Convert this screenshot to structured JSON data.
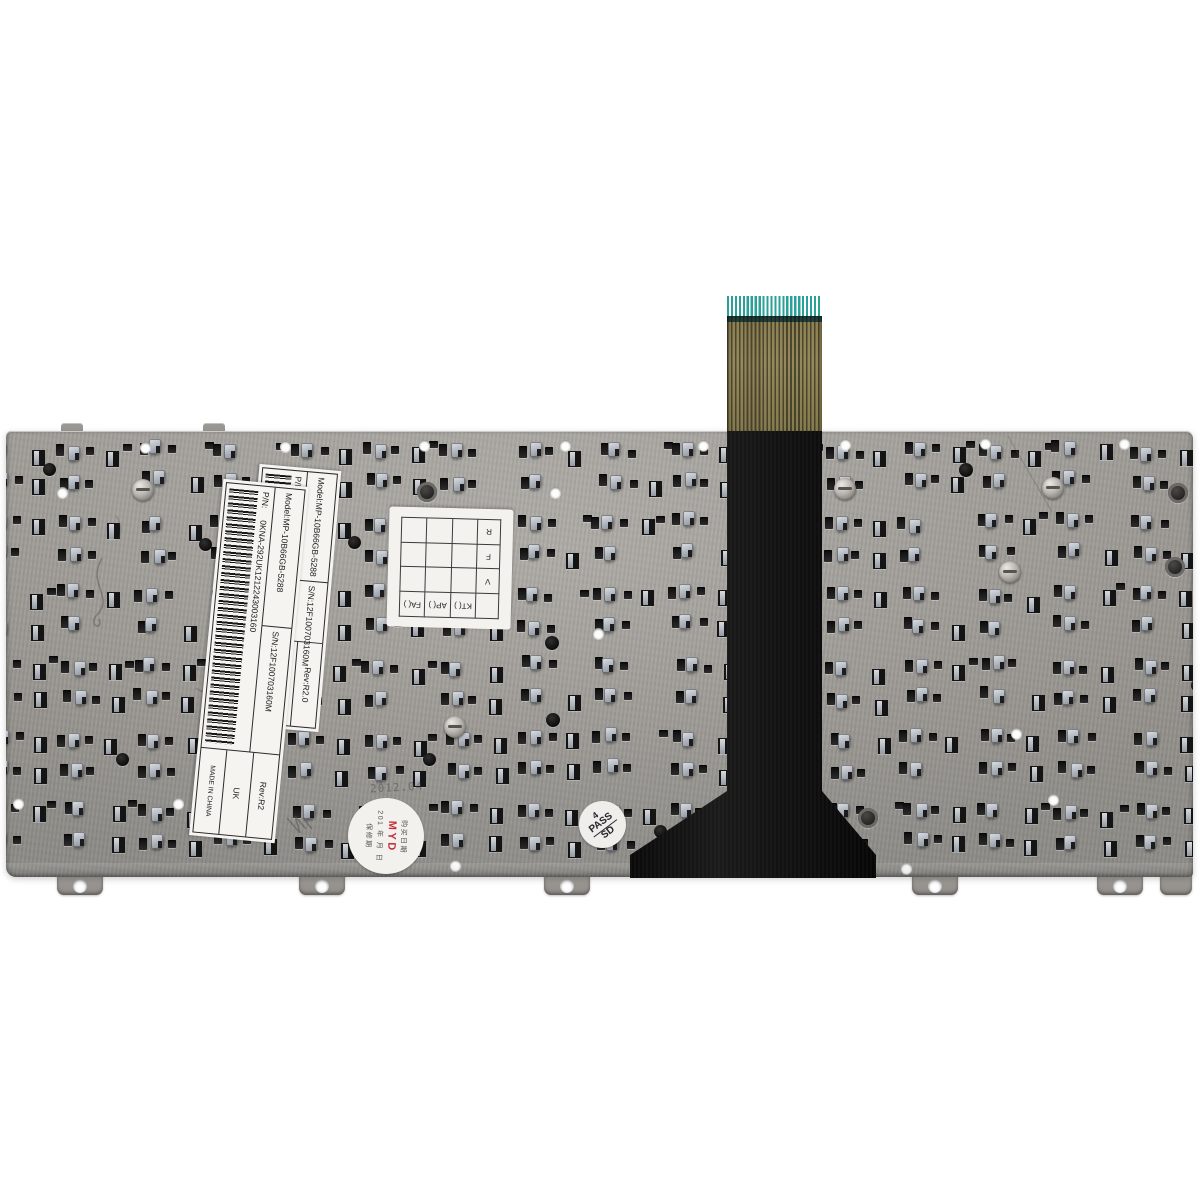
{
  "labels": {
    "label_a": {
      "model": "Model:MP-10B66GB-5288",
      "serial": "S/N:12F100703160M",
      "pn_prefix": "P/N:",
      "pn_code": "04GOA292KUK01-212243003160",
      "rev": "Rev:R2.0",
      "layout": "UK",
      "origin": "MADE IN CHINA"
    },
    "label_b": {
      "model": "Model:MP-10B66GB-5288",
      "serial": "S/N:12F100703160M",
      "pn_prefix": "P/N:",
      "pn_code": "0KNA-292UK1212243003160",
      "rev": "Rev:R2",
      "layout": "UK",
      "origin": "MADE IN CHINA"
    },
    "qc_grid": {
      "header": [
        "KT(  )",
        "AP(  )",
        "FA(  )"
      ],
      "rows": [
        "V",
        "F",
        "R"
      ]
    },
    "stamp_pass": {
      "line1": "4",
      "line2": "PASS",
      "line3": "SD"
    },
    "stamp_myd": {
      "col1": "购买日期",
      "myd": "MYD",
      "col2": "201 年 月 日",
      "col3": "保修期"
    },
    "plate_stamp": "2012.04"
  },
  "colors": {
    "background": "#ffffff",
    "plate_metal": "#a5a29d",
    "slot_dark": "#1a1a1a",
    "clip_light": "#c9ced4",
    "cable_black": "#121212",
    "cable_film_gold": "#8d8052",
    "cable_contact_teal": "#2aa198",
    "label_background": "#f5f4f0",
    "stamp_red": "#c5303a"
  }
}
